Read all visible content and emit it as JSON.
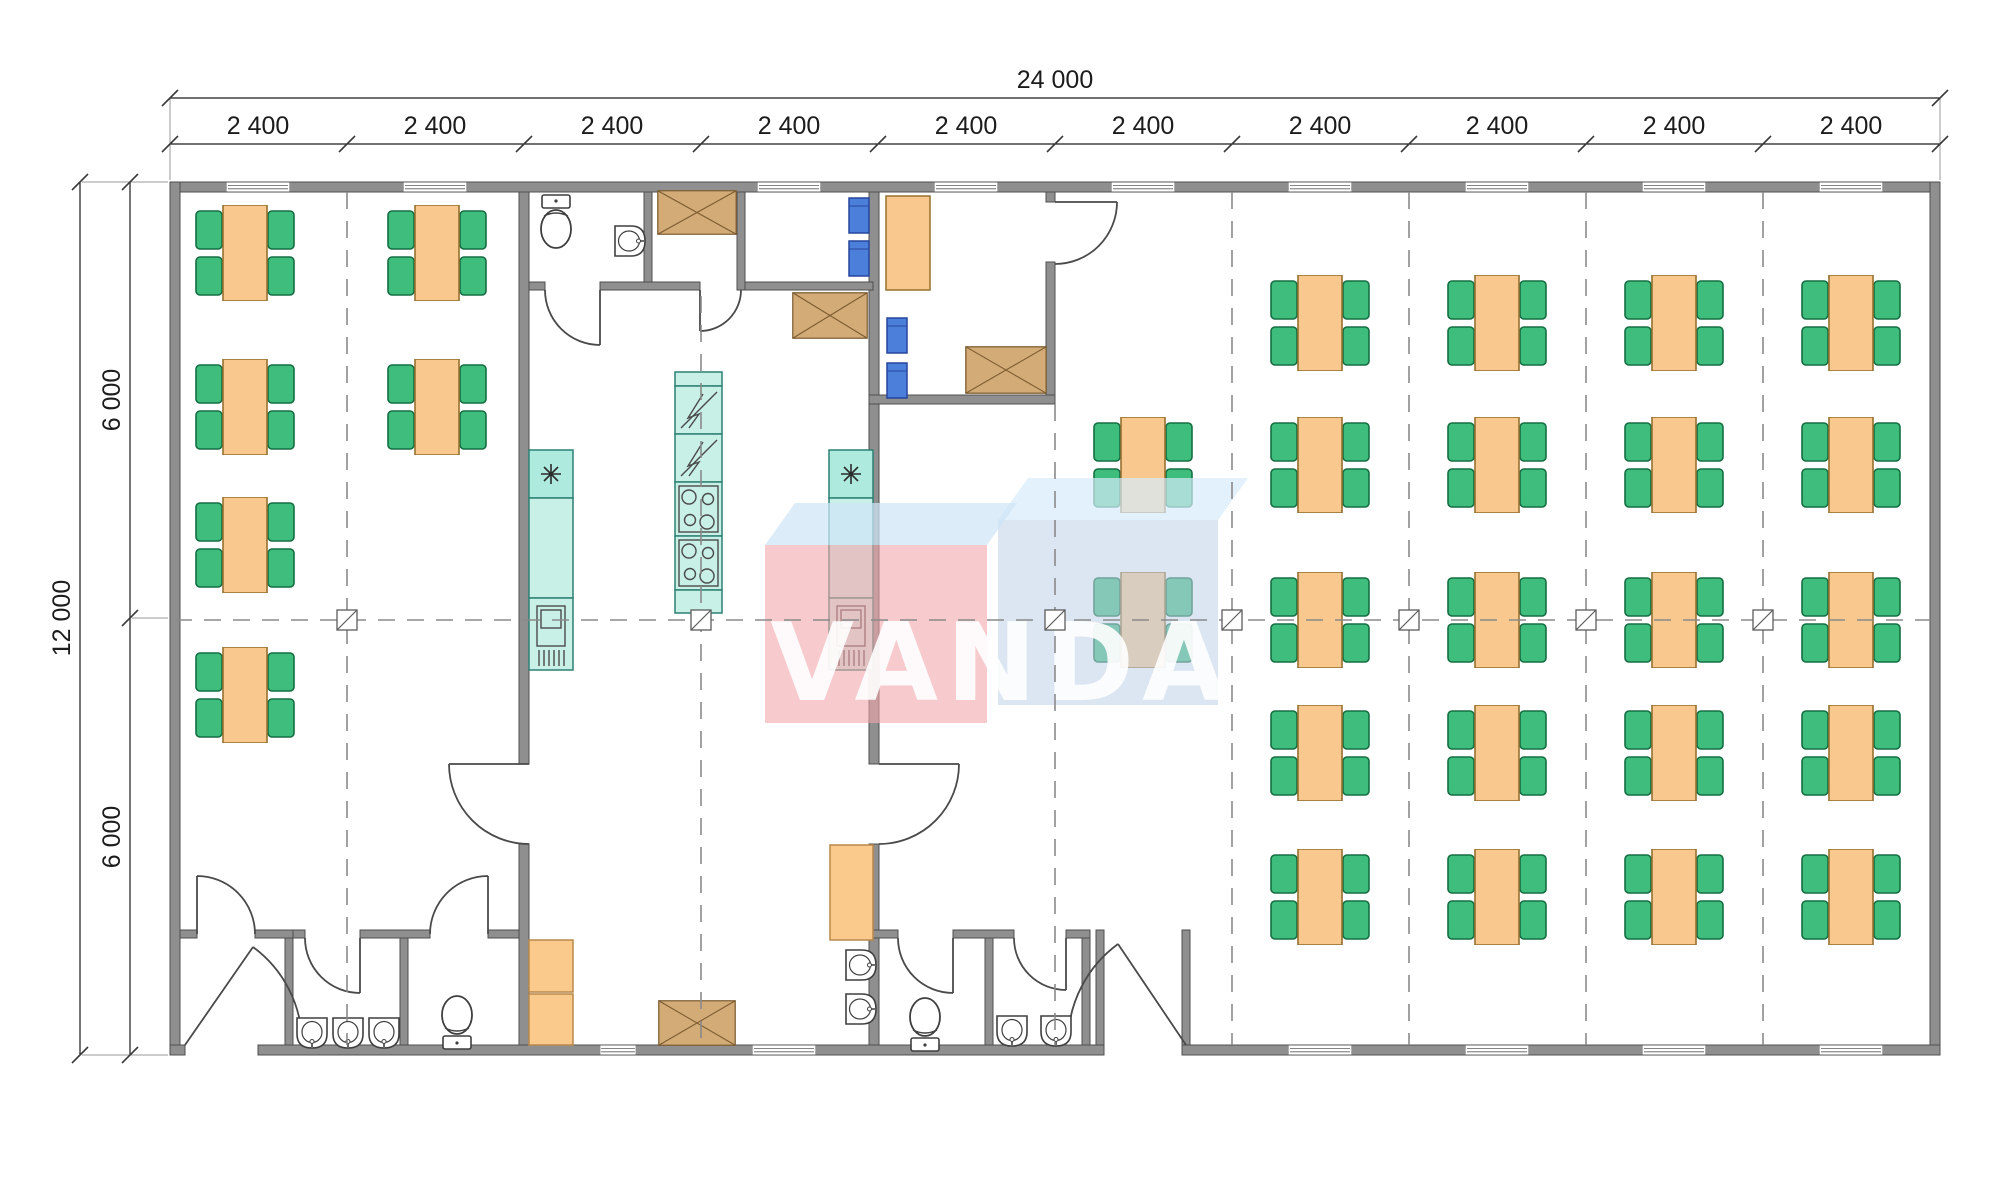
{
  "watermark": {
    "text": "VANDA"
  },
  "dimensions": {
    "top": {
      "overall": "24 000",
      "bay_labels": [
        "2 400",
        "2 400",
        "2 400",
        "2 400",
        "2 400",
        "2 400",
        "2 400",
        "2 400",
        "2 400",
        "2 400"
      ]
    },
    "left": {
      "overall": "12 000",
      "segment_labels": [
        "6 000",
        "6 000"
      ]
    }
  },
  "colors": {
    "wall": "#8f8f8f",
    "wallS": "#4f4f4f",
    "table": "#f8c88e",
    "tableS": "#96702f",
    "chair": "#3ebd7d",
    "chairS": "#156e42",
    "chairBlue": "#4b7fd9",
    "chairBlueS": "#27479e",
    "teal": "#aeeadd",
    "tealB": "#c9f0e7",
    "tealS": "#2d8173",
    "cab": "#f9ca8c",
    "cabS": "#b9874a",
    "xbox": "#d3ab76",
    "xboxS": "#7d5c31",
    "fixture": "#3f3f3f",
    "door": "#4a4a4a",
    "dash": "#8a8a8a",
    "dim": "#1c1c1c",
    "wmPink": "#f2a6ab",
    "wmPinkTop": "#cfe4f7",
    "wmBlue": "#bfd2e8",
    "wmBlueTop": "#d6ebfb",
    "wmText": "#ffffff"
  },
  "plan": {
    "tables": [
      [
        245,
        253
      ],
      [
        245,
        407
      ],
      [
        245,
        545
      ],
      [
        245,
        695
      ],
      [
        437,
        253
      ],
      [
        437,
        407
      ],
      [
        1143,
        465
      ],
      [
        1143,
        620
      ],
      [
        1320,
        323
      ],
      [
        1320,
        465
      ],
      [
        1320,
        620
      ],
      [
        1320,
        753
      ],
      [
        1320,
        897
      ],
      [
        1497,
        323
      ],
      [
        1497,
        465
      ],
      [
        1497,
        620
      ],
      [
        1497,
        753
      ],
      [
        1497,
        897
      ],
      [
        1674,
        323
      ],
      [
        1674,
        465
      ],
      [
        1674,
        620
      ],
      [
        1674,
        753
      ],
      [
        1674,
        897
      ],
      [
        1851,
        323
      ],
      [
        1851,
        465
      ],
      [
        1851,
        620
      ],
      [
        1851,
        753
      ],
      [
        1851,
        897
      ]
    ],
    "blue_chairs": [
      [
        848,
        197
      ],
      [
        848,
        240
      ],
      [
        886,
        317
      ],
      [
        886,
        362
      ]
    ],
    "crossed_boxes": [
      [
        657,
        190,
        80,
        45
      ],
      [
        792,
        292,
        76,
        47
      ],
      [
        965,
        346,
        82,
        48
      ],
      [
        658,
        1000,
        78,
        46
      ]
    ],
    "windows": {
      "top": [
        [
          258,
          64
        ],
        [
          435,
          64
        ],
        [
          789,
          64
        ],
        [
          966,
          64
        ],
        [
          1143,
          64
        ],
        [
          1320,
          64
        ],
        [
          1497,
          64
        ],
        [
          1674,
          64
        ],
        [
          1851,
          64
        ]
      ],
      "bottom": [
        [
          618,
          36
        ],
        [
          784,
          64
        ],
        [
          1320,
          64
        ],
        [
          1497,
          64
        ],
        [
          1674,
          64
        ],
        [
          1851,
          64
        ]
      ]
    },
    "fixtures": [
      {
        "sym": "toilet",
        "x": 534,
        "y": 194,
        "rot": 0
      },
      {
        "sym": "toilet",
        "x": 435,
        "y": 994,
        "rot": 180
      },
      {
        "sym": "toilet",
        "x": 903,
        "y": 996,
        "rot": 180
      },
      {
        "sym": "sink",
        "x": 612,
        "y": 224,
        "rot": -90
      },
      {
        "sym": "sink",
        "x": 294,
        "y": 1016,
        "rot": 0
      },
      {
        "sym": "sink",
        "x": 330,
        "y": 1016,
        "rot": 0
      },
      {
        "sym": "sink",
        "x": 366,
        "y": 1016,
        "rot": 0
      },
      {
        "sym": "sink",
        "x": 994,
        "y": 1014,
        "rot": 0
      },
      {
        "sym": "sink",
        "x": 1038,
        "y": 1014,
        "rot": 0
      },
      {
        "sym": "sink",
        "x": 843,
        "y": 948,
        "rot": -90
      },
      {
        "sym": "sink",
        "x": 843,
        "y": 992,
        "rot": -90
      }
    ],
    "grid": {
      "v_lines": [
        [
          347,
          192,
          1045
        ],
        [
          701,
          296,
          1045
        ],
        [
          1055,
          404,
          1045
        ],
        [
          1232,
          192,
          1045
        ],
        [
          1409,
          192,
          1045
        ],
        [
          1586,
          192,
          1045
        ],
        [
          1763,
          192,
          1045
        ]
      ],
      "h_line": [
        175,
        620,
        1935
      ],
      "markers": [
        347,
        701,
        1055,
        1232,
        1409,
        1586,
        1763
      ]
    },
    "bay_ticks": [
      170,
      347,
      524,
      701,
      878,
      1055,
      1232,
      1409,
      1586,
      1763,
      1940
    ],
    "bay_centers": [
      258,
      435,
      612,
      789,
      966,
      1143,
      1320,
      1497,
      1674,
      1851
    ]
  }
}
